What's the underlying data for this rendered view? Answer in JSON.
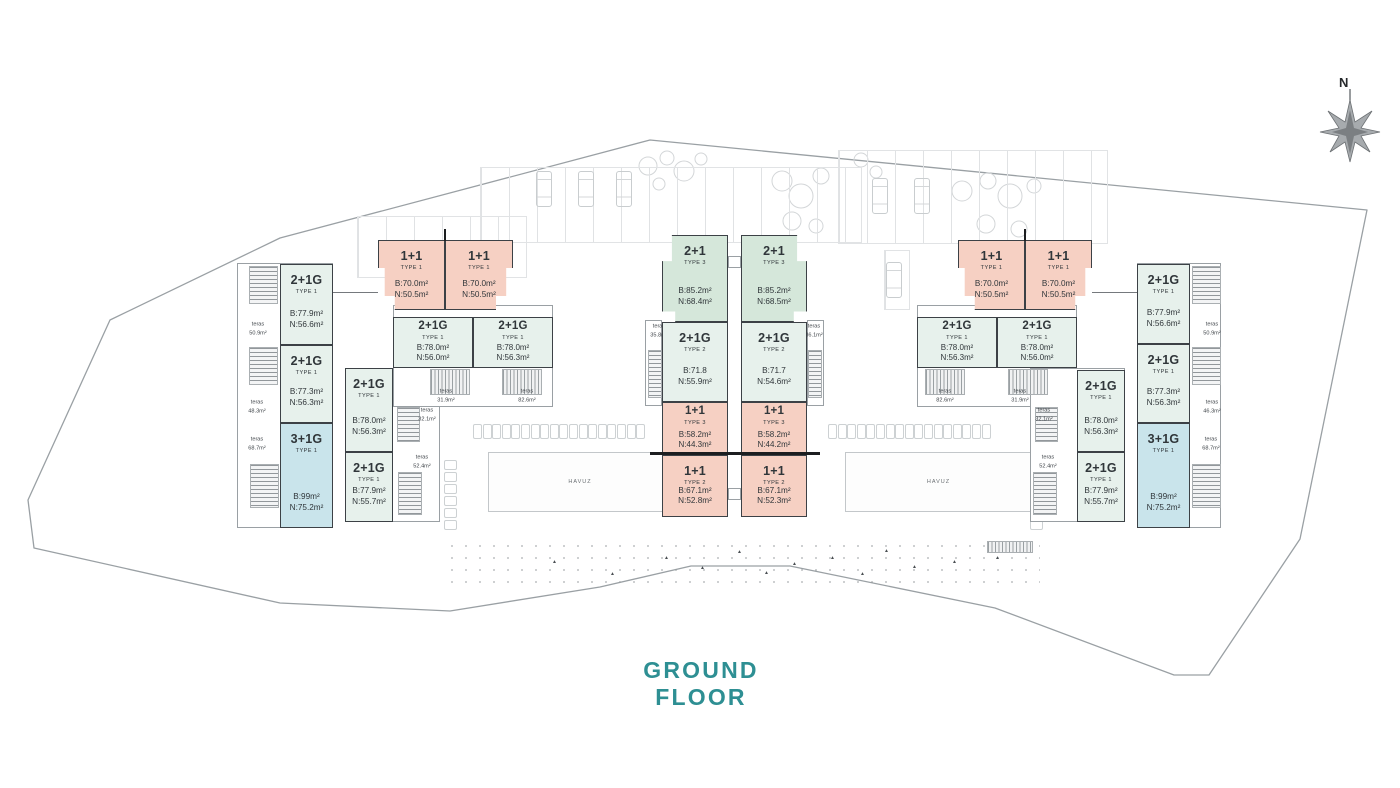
{
  "title": {
    "text": "GROUND FLOOR"
  },
  "compass": {
    "label": "N"
  },
  "palette": {
    "mint": "#e7f1ec",
    "green": "#d5e7da",
    "pink": "#f6d0c3",
    "blue": "#c9e4eb",
    "outline": "#3c4146",
    "thin_line": "#9aa0a4",
    "title_teal": "#2e8f93"
  },
  "units": [
    {
      "id": "a1",
      "name": "2+1G",
      "type": "TYPE 1",
      "b": "B:77.9m²",
      "n": "N:56.6m²",
      "color": "mint",
      "x": 280,
      "y": 264,
      "w": 53,
      "h": 81
    },
    {
      "id": "a2",
      "name": "2+1G",
      "type": "TYPE 1",
      "b": "B:77.3m²",
      "n": "N:56.3m²",
      "color": "mint",
      "x": 280,
      "y": 345,
      "w": 53,
      "h": 78
    },
    {
      "id": "a3",
      "name": "3+1G",
      "type": "TYPE 1",
      "b": "B:99m²",
      "n": "N:75.2m²",
      "color": "blue",
      "x": 280,
      "y": 423,
      "w": 53,
      "h": 105
    },
    {
      "id": "a4",
      "name": "2+1G",
      "type": "TYPE 1",
      "b": "B:78.0m²",
      "n": "N:56.3m²",
      "color": "mint",
      "x": 345,
      "y": 368,
      "w": 48,
      "h": 84
    },
    {
      "id": "a5",
      "name": "2+1G",
      "type": "TYPE 1",
      "b": "B:77.9m²",
      "n": "N:55.7m²",
      "color": "mint",
      "x": 345,
      "y": 452,
      "w": 48,
      "h": 70
    },
    {
      "id": "p1",
      "name": "1+1",
      "type": "TYPE 1",
      "b": "B:70.0m²",
      "n": "N:50.5m²",
      "color": "pink",
      "x": 378,
      "y": 240,
      "w": 67,
      "h": 70,
      "cls": "pair",
      "clip": "polygon(0 0,100% 0,100% 100%,25% 100%,25% 80%,10% 80%,10% 40%,0 40%)"
    },
    {
      "id": "p2",
      "name": "1+1",
      "type": "TYPE 1",
      "b": "B:70.0m²",
      "n": "N:50.5m²",
      "color": "pink",
      "x": 445,
      "y": 240,
      "w": 68,
      "h": 70,
      "cls": "pair",
      "clip": "polygon(0 0,100% 0,100% 40%,90% 40%,90% 80%,75% 80%,75% 100%,0 100%)"
    },
    {
      "id": "a6",
      "name": "2+1G",
      "type": "TYPE 1",
      "b": "B:78.0m²",
      "n": "N:56.0m²",
      "color": "mint",
      "x": 393,
      "y": 317,
      "w": 80,
      "h": 51,
      "cls": "compact"
    },
    {
      "id": "a7",
      "name": "2+1G",
      "type": "TYPE 1",
      "b": "B:78.0m²",
      "n": "N:56.3m²",
      "color": "mint",
      "x": 473,
      "y": 317,
      "w": 80,
      "h": 51,
      "cls": "compact"
    },
    {
      "id": "c1",
      "name": "2+1",
      "type": "TYPE 3",
      "b": "B:85.2m²",
      "n": "N:68.4m²",
      "color": "green",
      "x": 662,
      "y": 235,
      "w": 66,
      "h": 87,
      "clip": "polygon(15% 0,100% 0,100% 100%,20% 100%,20% 88%,0 88%,0 30%,15% 30%)"
    },
    {
      "id": "c2",
      "name": "2+1G",
      "type": "TYPE 2",
      "b": "B:71.8",
      "n": "N:55.9m²",
      "color": "mint",
      "x": 662,
      "y": 322,
      "w": 66,
      "h": 80
    },
    {
      "id": "c3",
      "name": "1+1",
      "type": "TYPE 3",
      "b": "B:58.2m²",
      "n": "N:44.3m²",
      "color": "pink",
      "x": 662,
      "y": 402,
      "w": 66,
      "h": 53,
      "cls": "compact"
    },
    {
      "id": "c4",
      "name": "1+1",
      "type": "TYPE 2",
      "b": "B:67.1m²",
      "n": "N:52.8m²",
      "color": "pink",
      "x": 662,
      "y": 455,
      "w": 66,
      "h": 62
    },
    {
      "id": "c5",
      "name": "2+1",
      "type": "TYPE 3",
      "b": "B:85.2m²",
      "n": "N:68.5m²",
      "color": "green",
      "x": 741,
      "y": 235,
      "w": 66,
      "h": 87,
      "clip": "polygon(0 0,85% 0,85% 30%,100% 30%,100% 88%,80% 88%,80% 100%,0 100%)"
    },
    {
      "id": "c6",
      "name": "2+1G",
      "type": "TYPE 2",
      "b": "B:71.7",
      "n": "N:54.6m²",
      "color": "mint",
      "x": 741,
      "y": 322,
      "w": 66,
      "h": 80
    },
    {
      "id": "c7",
      "name": "1+1",
      "type": "TYPE 3",
      "b": "B:58.2m²",
      "n": "N:44.2m²",
      "color": "pink",
      "x": 741,
      "y": 402,
      "w": 66,
      "h": 53,
      "cls": "compact"
    },
    {
      "id": "c8",
      "name": "1+1",
      "type": "TYPE 2",
      "b": "B:67.1m²",
      "n": "N:52.3m²",
      "color": "pink",
      "x": 741,
      "y": 455,
      "w": 66,
      "h": 62
    },
    {
      "id": "b1",
      "name": "2+1G",
      "type": "TYPE 1",
      "b": "B:78.0m²",
      "n": "N:56.3m²",
      "color": "mint",
      "x": 917,
      "y": 317,
      "w": 80,
      "h": 51,
      "cls": "compact"
    },
    {
      "id": "b2",
      "name": "2+1G",
      "type": "TYPE 1",
      "b": "B:78.0m²",
      "n": "N:56.0m²",
      "color": "mint",
      "x": 997,
      "y": 317,
      "w": 80,
      "h": 51,
      "cls": "compact"
    },
    {
      "id": "p3",
      "name": "1+1",
      "type": "TYPE 1",
      "b": "B:70.0m²",
      "n": "N:50.5m²",
      "color": "pink",
      "x": 958,
      "y": 240,
      "w": 67,
      "h": 70,
      "cls": "pair",
      "clip": "polygon(0 0,100% 0,100% 100%,25% 100%,25% 80%,10% 80%,10% 40%,0 40%)"
    },
    {
      "id": "p4",
      "name": "1+1",
      "type": "TYPE 1",
      "b": "B:70.0m²",
      "n": "N:50.5m²",
      "color": "pink",
      "x": 1025,
      "y": 240,
      "w": 67,
      "h": 70,
      "cls": "pair",
      "clip": "polygon(0 0,100% 0,100% 40%,90% 40%,90% 80%,75% 80%,75% 100%,0 100%)"
    },
    {
      "id": "b3",
      "name": "2+1G",
      "type": "TYPE 1",
      "b": "B:78.0m²",
      "n": "N:56.3m²",
      "color": "mint",
      "x": 1077,
      "y": 370,
      "w": 48,
      "h": 82
    },
    {
      "id": "b4",
      "name": "2+1G",
      "type": "TYPE 1",
      "b": "B:77.9m²",
      "n": "N:55.7m²",
      "color": "mint",
      "x": 1077,
      "y": 452,
      "w": 48,
      "h": 70
    },
    {
      "id": "b5",
      "name": "2+1G",
      "type": "TYPE 1",
      "b": "B:77.9m²",
      "n": "N:56.6m²",
      "color": "mint",
      "x": 1137,
      "y": 264,
      "w": 53,
      "h": 80
    },
    {
      "id": "b6",
      "name": "2+1G",
      "type": "TYPE 1",
      "b": "B:77.3m²",
      "n": "N:56.3m²",
      "color": "mint",
      "x": 1137,
      "y": 344,
      "w": 53,
      "h": 79
    },
    {
      "id": "b7",
      "name": "3+1G",
      "type": "TYPE 1",
      "b": "B:99m²",
      "n": "N:75.2m²",
      "color": "blue",
      "x": 1137,
      "y": 423,
      "w": 53,
      "h": 105
    }
  ],
  "teras_labels": [
    {
      "word": "teras",
      "area": "50.9m²",
      "x": 258,
      "y": 329
    },
    {
      "word": "teras",
      "area": "48.3m²",
      "x": 257,
      "y": 407
    },
    {
      "word": "teras",
      "area": "68.7m²",
      "x": 257,
      "y": 444
    },
    {
      "word": "teras",
      "area": "32.1m²",
      "x": 427,
      "y": 415
    },
    {
      "word": "teras",
      "area": "52.4m²",
      "x": 422,
      "y": 462
    },
    {
      "word": "teras",
      "area": "31.9m²",
      "x": 446,
      "y": 396
    },
    {
      "word": "teras",
      "area": "82.6m²",
      "x": 527,
      "y": 396
    },
    {
      "word": "teras",
      "area": "35.8m²",
      "x": 659,
      "y": 331
    },
    {
      "word": "teras",
      "area": "36.1m²",
      "x": 814,
      "y": 331
    },
    {
      "word": "teras",
      "area": "82.6m²",
      "x": 945,
      "y": 396
    },
    {
      "word": "teras",
      "area": "31.9m²",
      "x": 1020,
      "y": 396
    },
    {
      "word": "teras",
      "area": "32.1m²",
      "x": 1044,
      "y": 415
    },
    {
      "word": "teras",
      "area": "52.4m²",
      "x": 1048,
      "y": 462
    },
    {
      "word": "teras",
      "area": "50.9m²",
      "x": 1212,
      "y": 329
    },
    {
      "word": "teras",
      "area": "46.3m²",
      "x": 1212,
      "y": 407
    },
    {
      "word": "teras",
      "area": "68.7m²",
      "x": 1211,
      "y": 444
    }
  ],
  "pools": [
    {
      "label": "HAVUZ",
      "x": 488,
      "y": 452,
      "w": 182,
      "h": 58
    },
    {
      "label": "HAVUZ",
      "x": 845,
      "y": 452,
      "w": 185,
      "h": 58
    }
  ],
  "structure": {
    "boxes": [
      {
        "x": 237,
        "y": 263,
        "w": 96,
        "h": 265
      },
      {
        "x": 345,
        "y": 368,
        "w": 95,
        "h": 154
      },
      {
        "x": 393,
        "y": 305,
        "w": 160,
        "h": 102
      },
      {
        "x": 645,
        "y": 320,
        "w": 17,
        "h": 86
      },
      {
        "x": 807,
        "y": 320,
        "w": 17,
        "h": 86
      },
      {
        "x": 728,
        "y": 256,
        "w": 13,
        "h": 12
      },
      {
        "x": 728,
        "y": 488,
        "w": 13,
        "h": 12
      },
      {
        "x": 917,
        "y": 305,
        "w": 160,
        "h": 102
      },
      {
        "x": 1030,
        "y": 368,
        "w": 95,
        "h": 154
      },
      {
        "x": 1137,
        "y": 263,
        "w": 84,
        "h": 265
      }
    ],
    "stairs": [
      {
        "x": 249,
        "y": 266,
        "w": 29,
        "h": 38
      },
      {
        "x": 249,
        "y": 347,
        "w": 29,
        "h": 38
      },
      {
        "x": 250,
        "y": 464,
        "w": 29,
        "h": 44
      },
      {
        "x": 397,
        "y": 407,
        "w": 23,
        "h": 35
      },
      {
        "x": 398,
        "y": 472,
        "w": 24,
        "h": 43
      },
      {
        "x": 430,
        "y": 369,
        "w": 40,
        "h": 26,
        "v": true
      },
      {
        "x": 502,
        "y": 369,
        "w": 40,
        "h": 26,
        "v": true
      },
      {
        "x": 648,
        "y": 350,
        "w": 14,
        "h": 48
      },
      {
        "x": 808,
        "y": 350,
        "w": 14,
        "h": 48
      },
      {
        "x": 925,
        "y": 369,
        "w": 40,
        "h": 26,
        "v": true
      },
      {
        "x": 1008,
        "y": 369,
        "w": 40,
        "h": 26,
        "v": true
      },
      {
        "x": 1035,
        "y": 407,
        "w": 23,
        "h": 35
      },
      {
        "x": 1033,
        "y": 472,
        "w": 24,
        "h": 43
      },
      {
        "x": 1192,
        "y": 266,
        "w": 29,
        "h": 38
      },
      {
        "x": 1192,
        "y": 347,
        "w": 29,
        "h": 38
      },
      {
        "x": 1192,
        "y": 464,
        "w": 29,
        "h": 44
      },
      {
        "x": 987,
        "y": 541,
        "w": 46,
        "h": 12,
        "v": true
      }
    ],
    "lines": [
      {
        "x": 333,
        "y": 292,
        "w": 45,
        "h": 1
      },
      {
        "x": 1092,
        "y": 292,
        "w": 45,
        "h": 1
      },
      {
        "x": 650,
        "y": 452,
        "w": 170,
        "h": 2.5,
        "dark": true
      },
      {
        "x": 444,
        "y": 229,
        "w": 2,
        "h": 12,
        "dark": true
      },
      {
        "x": 1024,
        "y": 229,
        "w": 2,
        "h": 12,
        "dark": true
      }
    ]
  },
  "site": {
    "boundary_points": "650,140 1367,210 1300,539 1209,675 1174,675 995,608 790,566 691,566 600,587 450,611 280,603 34,548 28,500 110,320 280,238"
  },
  "background": {
    "stalls": [
      {
        "x": 357,
        "y": 216,
        "w": 168,
        "h": 60
      },
      {
        "x": 480,
        "y": 167,
        "w": 380,
        "h": 74
      },
      {
        "x": 838,
        "y": 150,
        "w": 268,
        "h": 92
      },
      {
        "x": 884,
        "y": 250,
        "w": 24,
        "h": 58
      }
    ],
    "cars": [
      {
        "x": 536,
        "y": 171
      },
      {
        "x": 578,
        "y": 171
      },
      {
        "x": 616,
        "y": 171
      },
      {
        "x": 872,
        "y": 178
      },
      {
        "x": 914,
        "y": 178
      },
      {
        "x": 886,
        "y": 262
      }
    ],
    "trees": [
      {
        "cx": 648,
        "cy": 166,
        "r": 9
      },
      {
        "cx": 667,
        "cy": 158,
        "r": 7
      },
      {
        "cx": 684,
        "cy": 171,
        "r": 10
      },
      {
        "cx": 701,
        "cy": 159,
        "r": 6
      },
      {
        "cx": 659,
        "cy": 184,
        "r": 6
      },
      {
        "cx": 782,
        "cy": 181,
        "r": 10
      },
      {
        "cx": 801,
        "cy": 196,
        "r": 12
      },
      {
        "cx": 821,
        "cy": 176,
        "r": 8
      },
      {
        "cx": 792,
        "cy": 221,
        "r": 9
      },
      {
        "cx": 816,
        "cy": 226,
        "r": 7
      },
      {
        "cx": 962,
        "cy": 191,
        "r": 10
      },
      {
        "cx": 988,
        "cy": 181,
        "r": 8
      },
      {
        "cx": 1010,
        "cy": 196,
        "r": 12
      },
      {
        "cx": 1034,
        "cy": 186,
        "r": 7
      },
      {
        "cx": 986,
        "cy": 224,
        "r": 9
      },
      {
        "cx": 1019,
        "cy": 229,
        "r": 8
      },
      {
        "cx": 861,
        "cy": 160,
        "r": 7
      },
      {
        "cx": 876,
        "cy": 172,
        "r": 6
      }
    ],
    "shrub_rows": [
      {
        "x": 473,
        "y": 424,
        "n": 18,
        "dx": 9.6,
        "w": 7,
        "h": 13
      },
      {
        "x": 828,
        "y": 424,
        "n": 17,
        "dx": 9.6,
        "w": 7,
        "h": 13
      }
    ],
    "shrub_cols": [
      {
        "x": 444,
        "y": 460,
        "n": 6,
        "dy": 12,
        "w": 11,
        "h": 8
      },
      {
        "x": 1030,
        "y": 460,
        "n": 6,
        "dy": 12,
        "w": 11,
        "h": 8
      }
    ],
    "stipple": {
      "x": 445,
      "y": 540,
      "w": 595,
      "h": 48
    },
    "triangles": [
      {
        "x": 552,
        "y": 560
      },
      {
        "x": 610,
        "y": 572
      },
      {
        "x": 664,
        "y": 556
      },
      {
        "x": 700,
        "y": 566
      },
      {
        "x": 737,
        "y": 550
      },
      {
        "x": 764,
        "y": 571
      },
      {
        "x": 792,
        "y": 562
      },
      {
        "x": 830,
        "y": 556
      },
      {
        "x": 860,
        "y": 572
      },
      {
        "x": 884,
        "y": 549
      },
      {
        "x": 912,
        "y": 565
      },
      {
        "x": 952,
        "y": 560
      },
      {
        "x": 995,
        "y": 556
      }
    ]
  }
}
